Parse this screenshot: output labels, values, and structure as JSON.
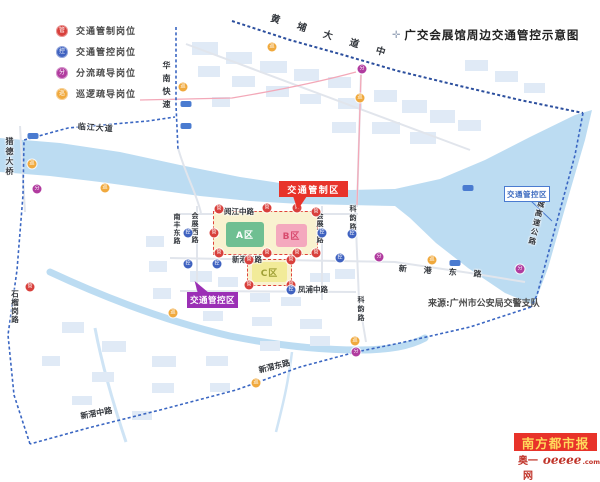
{
  "title": {
    "label": "广交会展馆周边交通管控示意图",
    "icon": "compass-icon"
  },
  "legend": {
    "items": [
      {
        "id": "control",
        "label": "交通管制岗位",
        "color": "#d8403c",
        "glyph": "管"
      },
      {
        "id": "monitor",
        "label": "交通管控岗位",
        "color": "#3f62c0",
        "glyph": "控"
      },
      {
        "id": "divert",
        "label": "分流疏导岗位",
        "color": "#b13b9f",
        "glyph": "分"
      },
      {
        "id": "patrol",
        "label": "巡逻疏导岗位",
        "color": "#f0a93d",
        "glyph": "巡"
      }
    ]
  },
  "callouts": {
    "control_zone": {
      "label": "交通管制区",
      "bg": "#e8332a"
    },
    "manage_zone_purple": {
      "label": "交通管控区",
      "bg": "#9b30b5"
    },
    "manage_zone_blue": {
      "label": "交通管控区",
      "color": "#3f6cc0"
    }
  },
  "zones": {
    "a": "A区",
    "b": "B区",
    "c": "C区"
  },
  "colors": {
    "zone_a": "#6fbf92",
    "zone_b": "#f4a9be",
    "zone_b_text": "#d84a6e",
    "zone_c": "#f2eb99",
    "zone_c_text": "#a0a036",
    "boundary": "#3a66c2",
    "water": "#bcdcf2",
    "control_red": "#e8332a"
  },
  "map": {
    "road_labels": [
      {
        "text": "黄埔大道中",
        "x": 272,
        "y": 14,
        "rot": 17,
        "spacing": 18,
        "size": 9.5,
        "weight": 700
      },
      {
        "text": "临江大道",
        "x": 78,
        "y": 123,
        "rot": 4,
        "spacing": 1,
        "size": 8,
        "weight": 700
      },
      {
        "text": "猎德大桥",
        "x": 5,
        "y": 137,
        "vertical": true,
        "size": 8,
        "spacing": 2,
        "weight": 700
      },
      {
        "text": "华南快速",
        "x": 162,
        "y": 61,
        "vertical": true,
        "size": 8,
        "spacing": 5,
        "weight": 700
      },
      {
        "text": "南丰东路",
        "x": 173,
        "y": 213,
        "vertical": true,
        "size": 7,
        "spacing": 1
      },
      {
        "text": "会展西路",
        "x": 191,
        "y": 212,
        "vertical": true,
        "size": 7,
        "spacing": 1
      },
      {
        "text": "会展东路",
        "x": 316,
        "y": 212,
        "vertical": true,
        "size": 7,
        "spacing": 1
      },
      {
        "text": "科韵路",
        "x": 349,
        "y": 205,
        "vertical": true,
        "size": 7,
        "spacing": 2
      },
      {
        "text": "科韵路",
        "x": 357,
        "y": 296,
        "vertical": true,
        "size": 7,
        "spacing": 2
      },
      {
        "text": "阅江中路",
        "x": 224,
        "y": 208,
        "size": 7.5
      },
      {
        "text": "新港东路",
        "x": 232,
        "y": 256,
        "size": 7.5
      },
      {
        "text": "新港东路",
        "x": 399,
        "y": 265,
        "rot": 4,
        "spacing": 17,
        "size": 8
      },
      {
        "text": "凤浦中路",
        "x": 298,
        "y": 286,
        "size": 7.5
      },
      {
        "text": "新滘东路",
        "x": 258,
        "y": 367,
        "rot": -14,
        "size": 8,
        "weight": 700
      },
      {
        "text": "新滘中路",
        "x": 80,
        "y": 413,
        "rot": -11,
        "size": 8,
        "weight": 700
      },
      {
        "text": "石榴岗路",
        "x": 11,
        "y": 290,
        "vertical": true,
        "size": 7.5,
        "spacing": 1
      },
      {
        "text": "环城高速公路",
        "x": 540,
        "y": 190,
        "vertical": true,
        "rot": 13,
        "size": 7.5,
        "spacing": 2
      }
    ],
    "markers": [
      {
        "t": "control",
        "x": 219,
        "y": 209
      },
      {
        "t": "control",
        "x": 267,
        "y": 208
      },
      {
        "t": "control",
        "x": 297,
        "y": 208
      },
      {
        "t": "control",
        "x": 316,
        "y": 212
      },
      {
        "t": "control",
        "x": 214,
        "y": 233
      },
      {
        "t": "control",
        "x": 219,
        "y": 253
      },
      {
        "t": "control",
        "x": 267,
        "y": 253
      },
      {
        "t": "control",
        "x": 297,
        "y": 253
      },
      {
        "t": "control",
        "x": 316,
        "y": 253
      },
      {
        "t": "control",
        "x": 249,
        "y": 260
      },
      {
        "t": "control",
        "x": 291,
        "y": 260
      },
      {
        "t": "control",
        "x": 249,
        "y": 285
      },
      {
        "t": "control",
        "x": 291,
        "y": 285
      },
      {
        "t": "control",
        "x": 30,
        "y": 287
      },
      {
        "t": "monitor",
        "x": 188,
        "y": 233
      },
      {
        "t": "monitor",
        "x": 188,
        "y": 264
      },
      {
        "t": "monitor",
        "x": 217,
        "y": 264
      },
      {
        "t": "monitor",
        "x": 322,
        "y": 233
      },
      {
        "t": "monitor",
        "x": 352,
        "y": 234
      },
      {
        "t": "monitor",
        "x": 340,
        "y": 258
      },
      {
        "t": "monitor",
        "x": 291,
        "y": 290
      },
      {
        "t": "divert",
        "x": 37,
        "y": 189
      },
      {
        "t": "divert",
        "x": 362,
        "y": 69
      },
      {
        "t": "divert",
        "x": 356,
        "y": 352
      },
      {
        "t": "divert",
        "x": 379,
        "y": 257
      },
      {
        "t": "divert",
        "x": 520,
        "y": 269
      },
      {
        "t": "patrol",
        "x": 272,
        "y": 47
      },
      {
        "t": "patrol",
        "x": 360,
        "y": 98
      },
      {
        "t": "patrol",
        "x": 183,
        "y": 87
      },
      {
        "t": "patrol",
        "x": 32,
        "y": 164
      },
      {
        "t": "patrol",
        "x": 105,
        "y": 188
      },
      {
        "t": "patrol",
        "x": 317,
        "y": 189
      },
      {
        "t": "patrol",
        "x": 173,
        "y": 313
      },
      {
        "t": "patrol",
        "x": 256,
        "y": 383
      },
      {
        "t": "patrol",
        "x": 355,
        "y": 341
      },
      {
        "t": "patrol",
        "x": 432,
        "y": 260
      }
    ],
    "shields": [
      [
        186,
        104
      ],
      [
        186,
        126
      ],
      [
        33,
        136
      ],
      [
        468,
        188
      ],
      [
        455,
        263
      ]
    ]
  },
  "source": "来源:广州市公安局交警支队",
  "branding": {
    "paper": "南方都市报",
    "site_prefix": "奥一网",
    "site_script": "oeeee",
    "site_suffix": ".com"
  }
}
